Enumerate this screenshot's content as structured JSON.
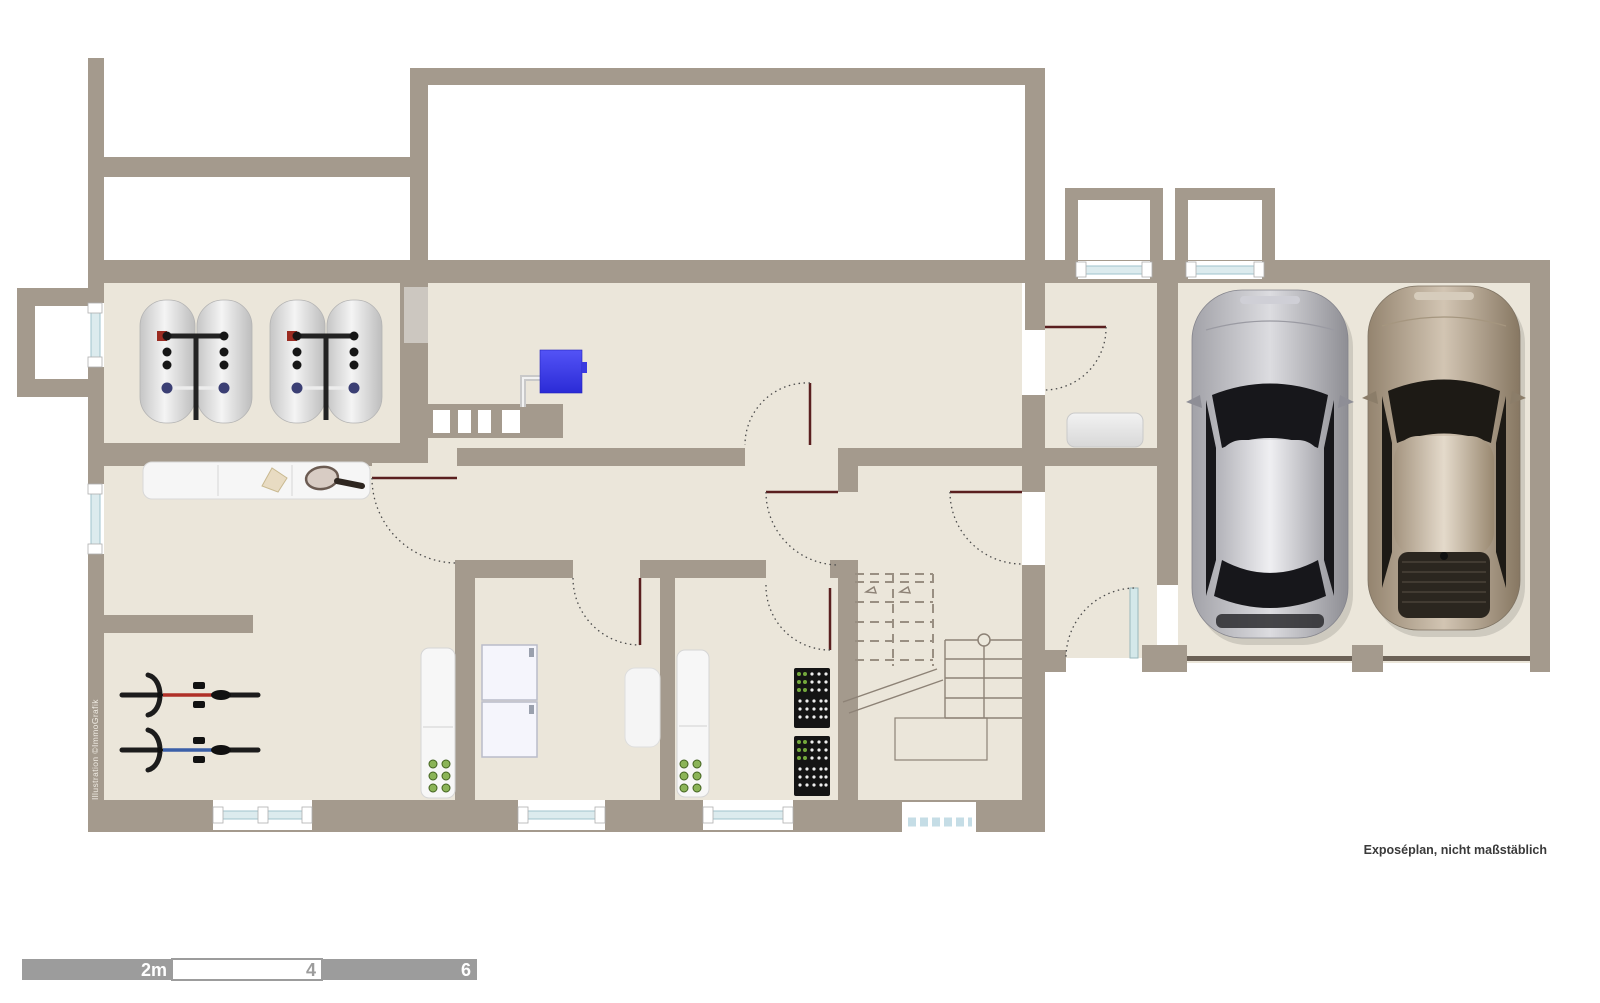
{
  "meta": {
    "note": "Exposéplan, nicht maßstäblich",
    "credit": "Illustration ©ImmoGrafik"
  },
  "scale_bar": {
    "labels": [
      "2m",
      "4",
      "6"
    ],
    "segment_meters": 2
  },
  "colors": {
    "wall": "#a49a8d",
    "floor": "#ebe6da",
    "window_glass": "#dcebee",
    "door_leaf": "#5a1f1f",
    "boiler": "#3c3cec",
    "scale_bar_gray": "#9c9c9c",
    "car_silver": "#b9b9bf",
    "car_beige": "#b4a694"
  },
  "plan": {
    "type": "basement-floor-plan",
    "garage_bays": 2,
    "windows_count": 8,
    "doors_count": 9,
    "inventory": [
      {
        "item": "hot-water-tank",
        "count": 4
      },
      {
        "item": "boiler-blue",
        "count": 1
      },
      {
        "item": "chimney-flues",
        "count": 4
      },
      {
        "item": "sideboard-with-tennis-racket",
        "count": 1
      },
      {
        "item": "bicycle",
        "count": 2
      },
      {
        "item": "storage-cabinet-with-jars",
        "count": 2
      },
      {
        "item": "washer-dryer",
        "count": 2
      },
      {
        "item": "beverage-crate-stack",
        "count": 2
      },
      {
        "item": "staircase",
        "count": 1
      },
      {
        "item": "car-silver",
        "count": 1
      },
      {
        "item": "car-beige",
        "count": 1
      },
      {
        "item": "small-table",
        "count": 2
      }
    ]
  }
}
